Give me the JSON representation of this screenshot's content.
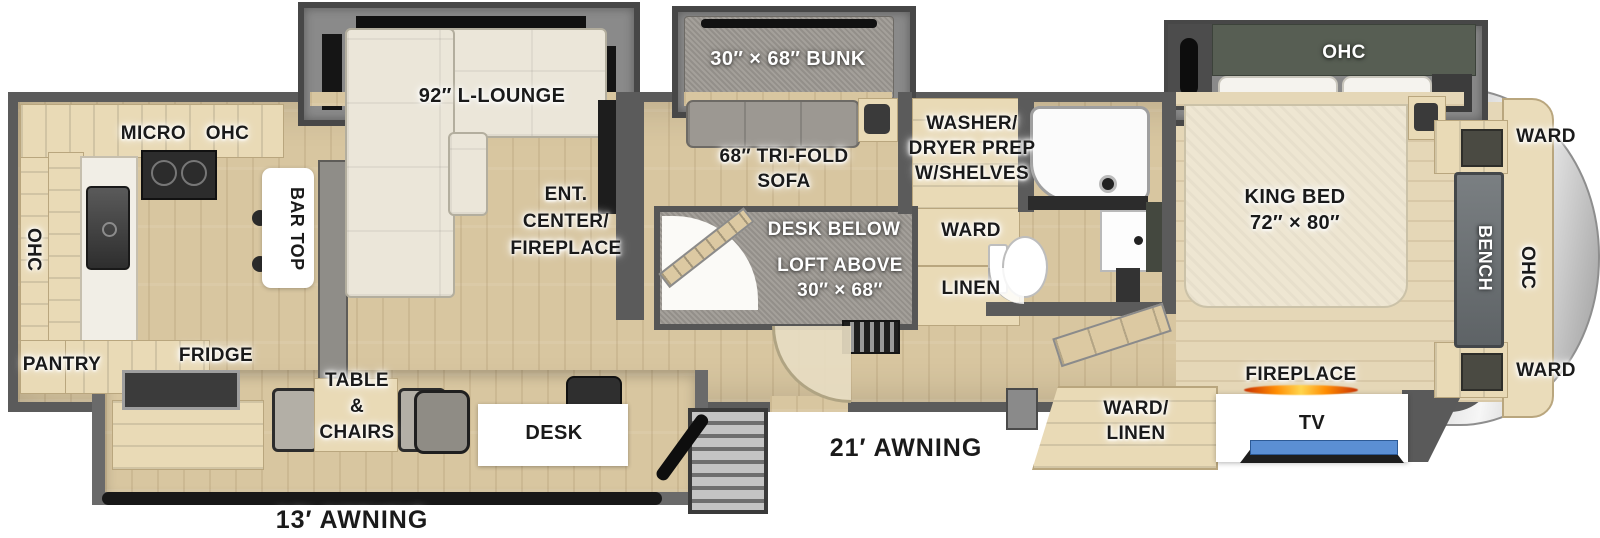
{
  "title": "Fifth wheel RV floorplan",
  "colors": {
    "wall": "#5b5b5b",
    "floor_wood": "#d8c6a0",
    "bedroom_floor": "#e5d7b7",
    "slide_gray": "#8a8a8a",
    "sofa_cream": "#ebe6d9",
    "cabinet_tan": "#e9dab6",
    "cap_silver": "#d6d6d6",
    "flame_orange": "#ff8c00",
    "tv_screen_blue": "#5b8fd4",
    "ohc_cabinet_green": "#575e53"
  },
  "labels": {
    "micro_ohc": "MICRO OHC",
    "ohc_rear": "OHC",
    "pantry": "PANTRY",
    "fridge": "FRIDGE",
    "bar_top": "BAR TOP",
    "l_lounge": "92″ L-LOUNGE",
    "ent_center": [
      "ENT.",
      "CENTER/",
      "FIREPLACE"
    ],
    "bunk": "30″ × 68″ BUNK",
    "tri_fold_sofa": [
      "68″ TRI-FOLD",
      "SOFA"
    ],
    "washer_dryer": [
      "WASHER/",
      "DRYER PREP",
      "W/SHELVES"
    ],
    "desk_below": "DESK BELOW",
    "loft_above": [
      "LOFT ABOVE",
      "30″ × 68″"
    ],
    "ward_hall": "WARD",
    "linen_hall": "LINEN",
    "king_bed": [
      "KING BED",
      "72″ × 80″"
    ],
    "ohc_bed_slide": "OHC",
    "ward_front_top": "WARD",
    "bench": "BENCH",
    "ohc_front": "OHC",
    "ward_front_bottom": "WARD",
    "fireplace": "FIREPLACE",
    "tv": "TV",
    "ward_linen": [
      "WARD/",
      "LINEN"
    ],
    "table_chairs": [
      "TABLE",
      "&",
      "CHAIRS"
    ],
    "desk": "DESK",
    "awning_21": "21′ AWNING",
    "awning_13": "13′ AWNING"
  }
}
